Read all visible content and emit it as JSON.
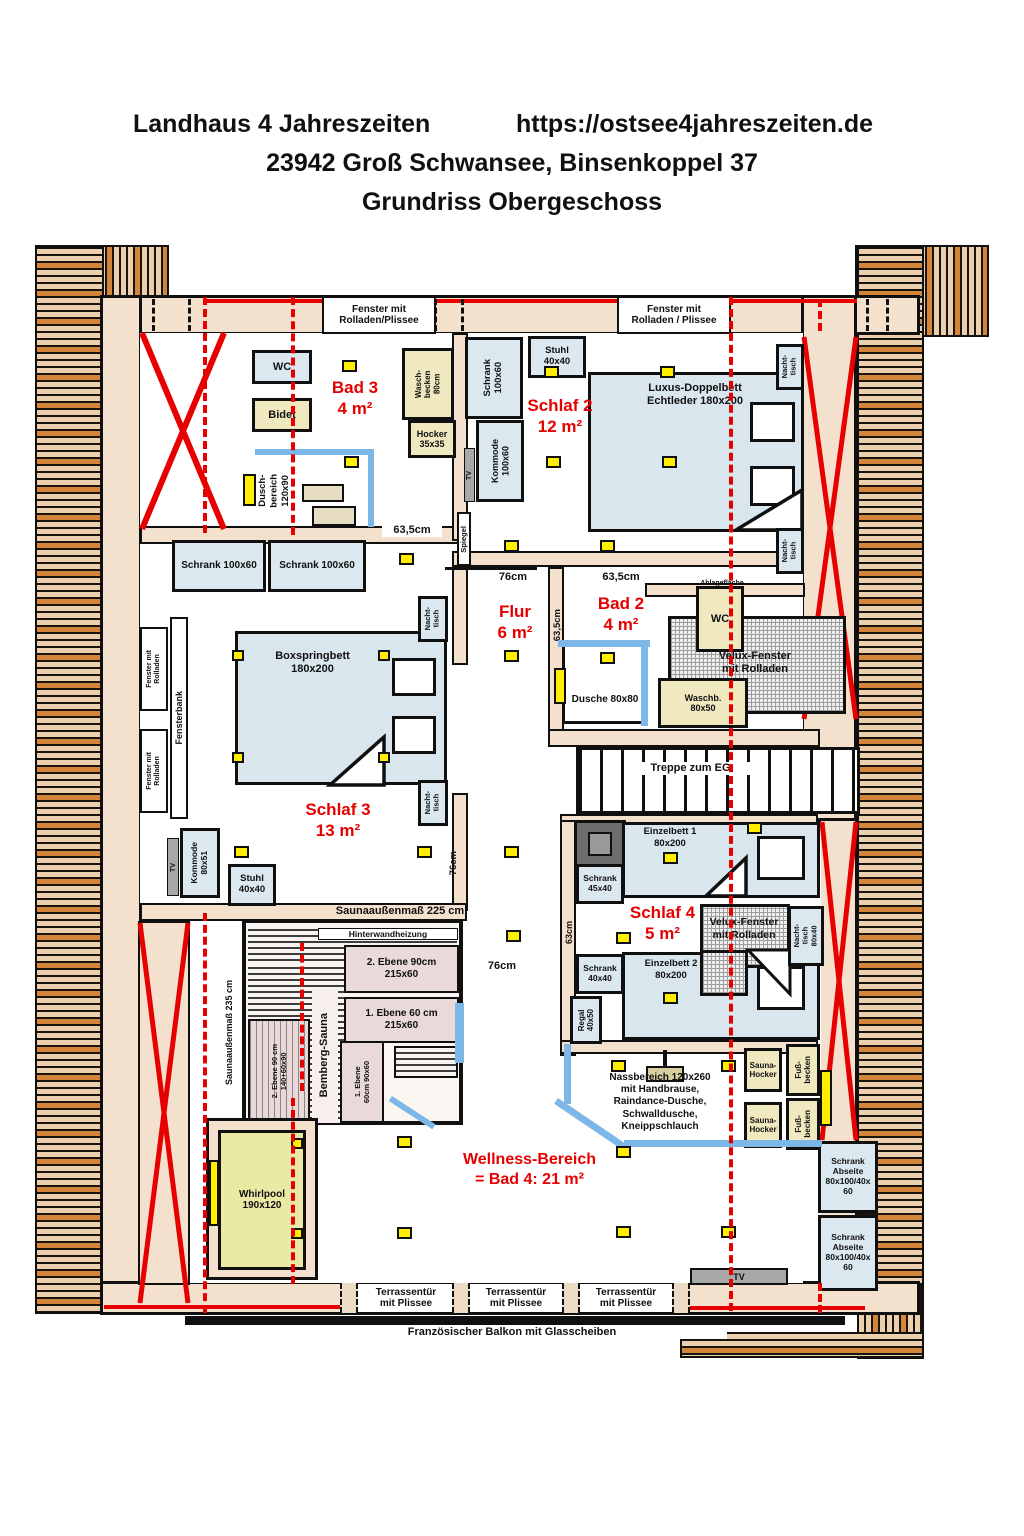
{
  "title": {
    "project": "Landhaus 4 Jahreszeiten",
    "url": "https://ostsee4jahreszeiten.de",
    "address": "23942 Groß Schwansee, Binsenkoppel 37",
    "subtitle": "Grundriss Obergeschoss"
  },
  "windows": {
    "top_left": "Fenster mit\nRolladen/Plissee",
    "top_right": "Fenster mit\nRolladen / Plissee",
    "side": "Fenster mit\nRolladen",
    "fensterbank": "Fensterbank",
    "velux": "Velux-Fenster\nmit Rolladen",
    "terrace_door": "Terrassentür\nmit Plissee",
    "french_balcony": "Französischer Balkon mit Glasscheiben"
  },
  "rooms": {
    "bad3": {
      "name": "Bad 3",
      "area": "4 m²"
    },
    "schlaf2": {
      "name": "Schlaf 2",
      "area": "12 m²"
    },
    "flur": {
      "name": "Flur",
      "area": "6 m²"
    },
    "bad2": {
      "name": "Bad 2",
      "area": "4 m²"
    },
    "schlaf3": {
      "name": "Schlaf 3",
      "area": "13 m²"
    },
    "schlaf4": {
      "name": "Schlaf 4",
      "area": "5 m²"
    },
    "wellness": {
      "name": "Wellness-Bereich",
      "area": "= Bad 4: 21 m²"
    },
    "treppe": "Treppe zum EG"
  },
  "furniture": {
    "wc": "WC",
    "bidet": "Bidet",
    "waschbecken80": "Wasch-\nbecken\n80cm",
    "hocker": "Hocker\n35x35",
    "duschbereich": "Dusch-\nbereich\n120x90",
    "stuhl": "Stuhl\n40x40",
    "schrank100v": "Schrank\n100x60",
    "schrank100h": "Schrank 100x60",
    "kommode100": "Kommode\n100x60",
    "tv": "TV",
    "doppelbett": "Luxus-Doppelbett\nEchtleder 180x200",
    "nachttisch": "Nacht-\ntisch",
    "spiegel": "Spiegel",
    "dusche80": "Dusche 80x80",
    "ablage": "Ablagefläche",
    "waschb50": "Waschb.\n80x50",
    "boxspringbett": "Boxspringbett\n180x200",
    "kommode80": "Kommode\n80x51",
    "einzelbett1": "Einzelbett 1\n80x200",
    "einzelbett2": "Einzelbett 2\n80x200",
    "schrank45": "Schrank\n45x40",
    "schrank40": "Schrank\n40x40",
    "nachttisch80": "Nacht-\ntisch\n80x40",
    "regal": "Regal\n40x50",
    "whirlpool": "Whirlpool\n190x120",
    "nassbereich": "Nassbereich 120x260\nmit Handbrause,\nRaindance-Dusche,\nSchwalldusche,\nKneippschlauch",
    "saunahocker": "Sauna-\nHocker",
    "fussbecken": "Fuß-\nbecken",
    "schrank_abseite": "Schrank\nAbseite\n80x100/40x\n60"
  },
  "sauna": {
    "name": "Bemberg-Sauna",
    "outer_w": "Saunaaußenmaß 225 cm",
    "outer_h": "Saunaaußenmaß 235 cm",
    "heater": "Hinterwandheizung",
    "bench2": "2. Ebene 90cm\n215x60",
    "bench1": "1. Ebene 60 cm\n215x60",
    "bench2b": "2. Ebene 90 cm\n140+60x90",
    "bench1b": "1. Ebene\n60cm  90x60"
  },
  "measurements": {
    "m635": "63,5cm",
    "m76": "76cm",
    "m63": "63cm"
  },
  "colors": {
    "wall": "#f4e1cd",
    "furniture_blue": "#dbe8ef",
    "fixture_yellow": "#f0e9c0",
    "spotlight_yellow": "#ffee00",
    "accent_red": "#e60000",
    "glass_blue": "#7db7e8",
    "wood_tan": "#ecd0ad",
    "wood_orange": "#d2853b"
  }
}
